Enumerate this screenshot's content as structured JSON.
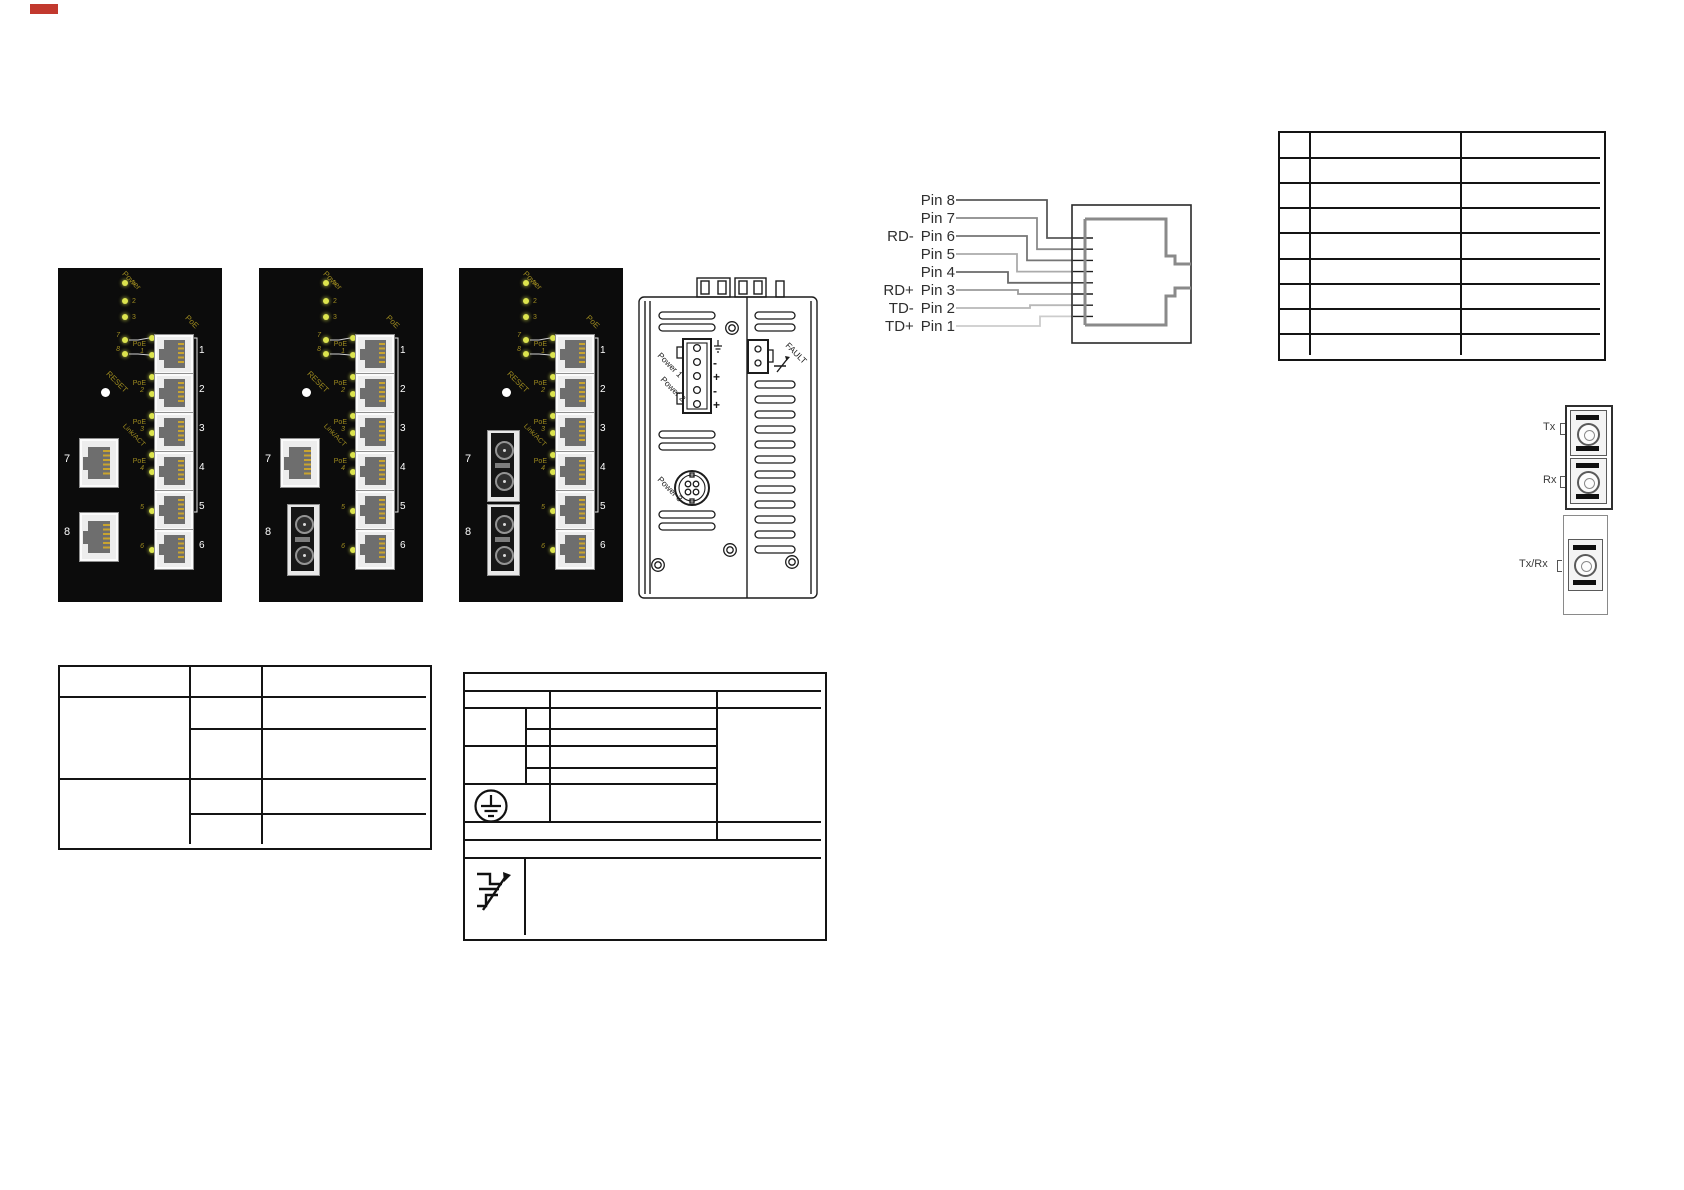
{
  "panels": {
    "power_label": "Power",
    "power_led_numbers": [
      "1",
      "2",
      "3"
    ],
    "uplink_led_numbers": [
      "7",
      "8"
    ],
    "poe_led_label": "PoE",
    "reset_label": "RESET",
    "link_act_label": "Link/ACT",
    "poe_group_label": "PoE",
    "port_led_numbers": [
      "1",
      "2",
      "3",
      "4",
      "5",
      "6"
    ],
    "port_numbers": [
      "1",
      "2",
      "3",
      "4",
      "5",
      "6"
    ],
    "uplink_port_numbers": [
      "7",
      "8"
    ],
    "items": [
      {
        "name": "front-panel-8-copper-ports",
        "port7": "rj45",
        "port8": "rj45"
      },
      {
        "name": "front-panel-7-copper-1-fiber",
        "port7": "rj45",
        "port8": "fiber"
      },
      {
        "name": "front-panel-6-copper-2-fiber",
        "port7": "fiber",
        "port8": "fiber"
      }
    ]
  },
  "device_top_view": {
    "power1_label": "Power 1",
    "power2_label": "Power 2",
    "power3_label": "Power 3",
    "fault_label": "FAULT",
    "terminal_polarity_marks": [
      "-",
      "+",
      "-",
      "+"
    ]
  },
  "rj45_pinout": {
    "pins": [
      {
        "signal": "",
        "pin_label": "Pin 8",
        "wire_color": "#5a5a5a"
      },
      {
        "signal": "",
        "pin_label": "Pin 7",
        "wire_color": "#8a8a8a"
      },
      {
        "signal": "RD-",
        "pin_label": "Pin 6",
        "wire_color": "#767676"
      },
      {
        "signal": "",
        "pin_label": "Pin 5",
        "wire_color": "#ababab"
      },
      {
        "signal": "",
        "pin_label": "Pin 4",
        "wire_color": "#6a6a6a"
      },
      {
        "signal": "RD+",
        "pin_label": "Pin 3",
        "wire_color": "#9a9a9a"
      },
      {
        "signal": "TD-",
        "pin_label": "Pin 2",
        "wire_color": "#b8b8b8"
      },
      {
        "signal": "TD+",
        "pin_label": "Pin 1",
        "wire_color": "#cccccc"
      }
    ]
  },
  "fiber_connectors": {
    "duplex": {
      "tx_label": "Tx",
      "rx_label": "Rx"
    },
    "simplex": {
      "txrx_label": "Tx/Rx"
    }
  },
  "tables": {
    "top_right": {
      "rows": 9,
      "columns": 3,
      "cells_empty": true
    },
    "bottom_left": {
      "columns": 3,
      "header_rows": 1,
      "sections": 2,
      "cells_empty": true
    },
    "bottom_middle": {
      "cells_empty": true,
      "icons": [
        "protective-earth-ground",
        "surge-impulse"
      ]
    }
  },
  "colors": {
    "panel_background": "#0c0c0c",
    "led_yellow": "#dce44e",
    "panel_label_olive": "#9d8a1f",
    "port_number_white": "#ffffff",
    "line_black": "#141414",
    "red_mark": "#c2392e"
  }
}
